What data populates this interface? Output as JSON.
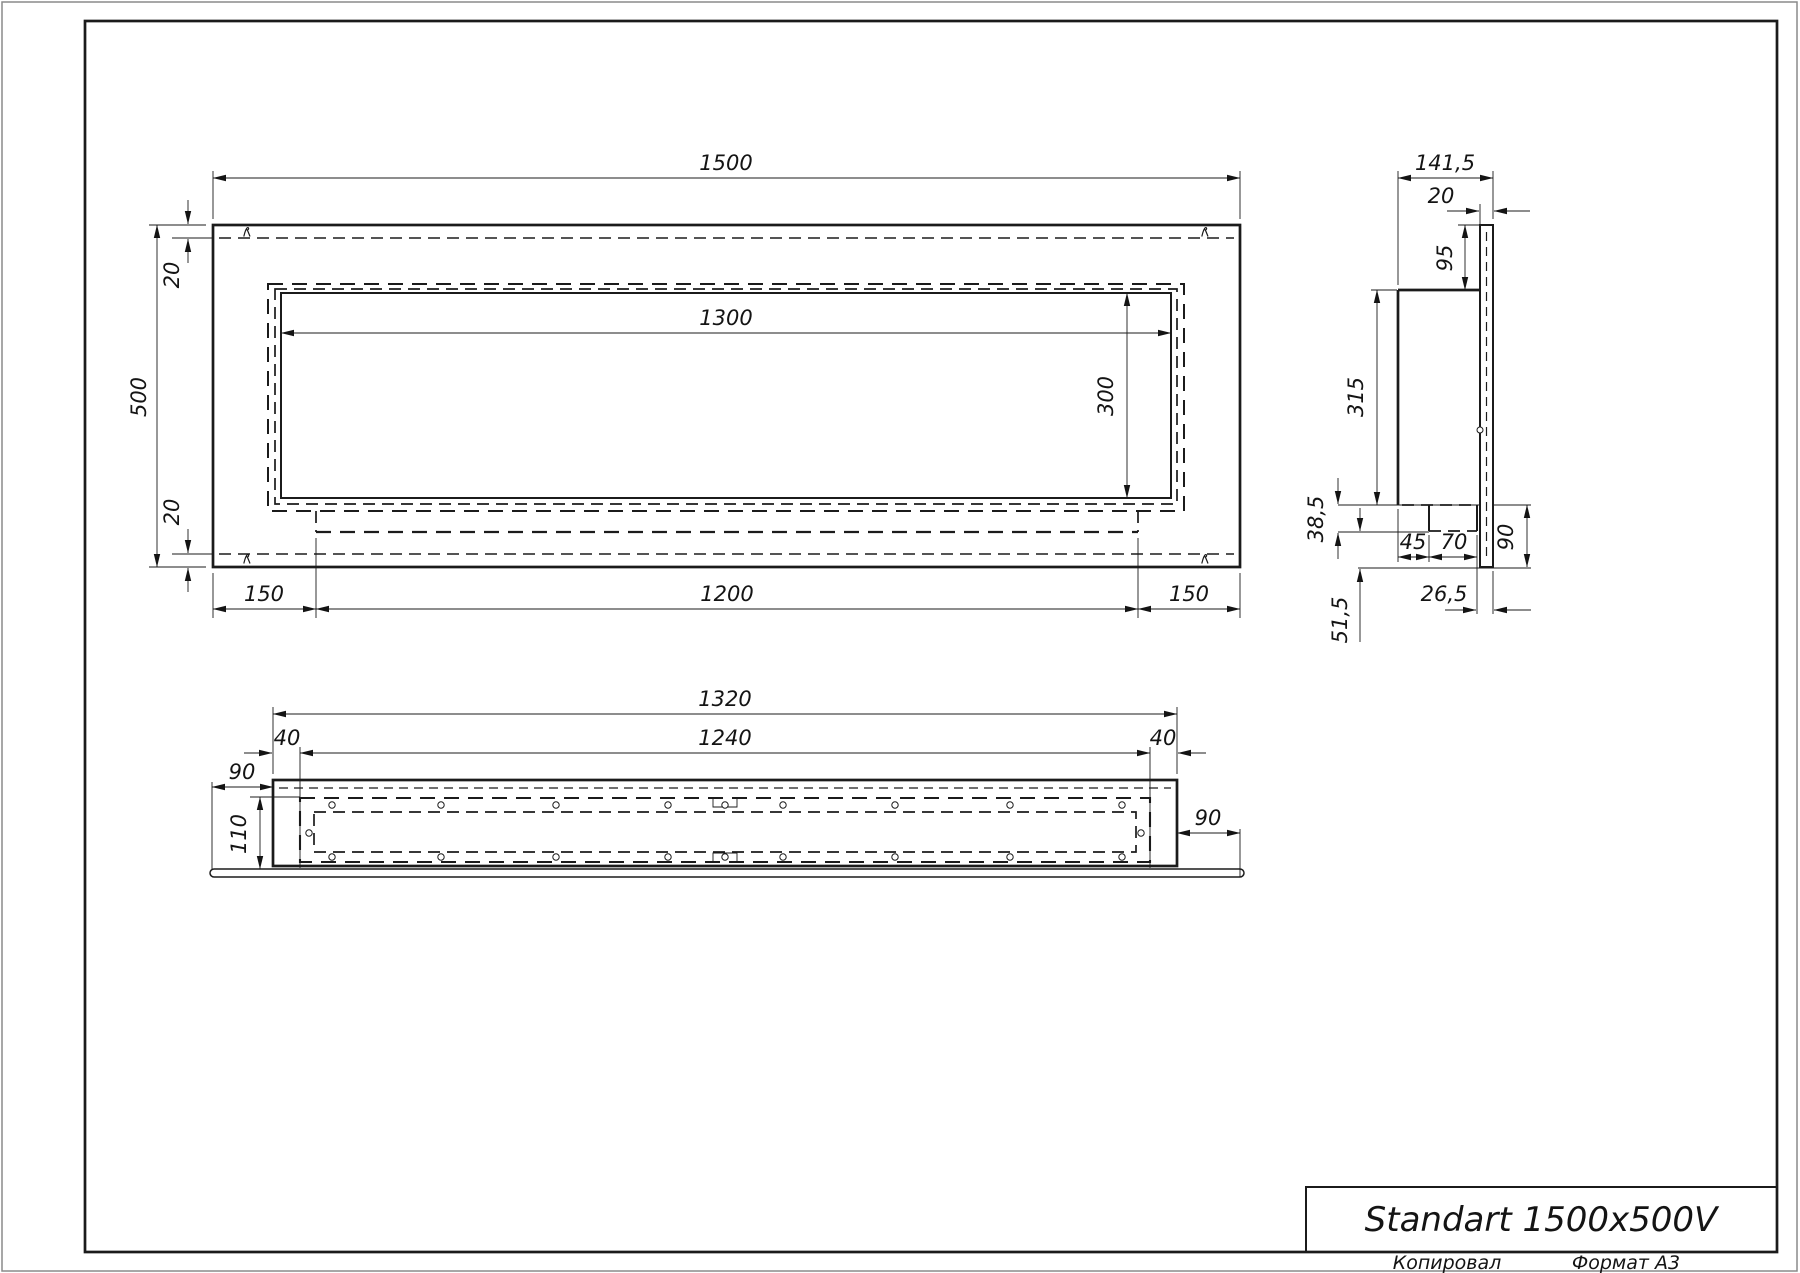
{
  "title_block": {
    "title": "Standart 1500x500V"
  },
  "footer": {
    "copied": "Копировал",
    "format": "Формат А3"
  },
  "dims": {
    "front": {
      "overall_width": "1500",
      "overall_height": "500",
      "top_margin": "20",
      "bottom_margin": "20",
      "opening_width": "1300",
      "opening_height": "300",
      "left_offset": "150",
      "burner_length": "1200",
      "right_offset": "150"
    },
    "side": {
      "overall_depth": "141,5",
      "panel_thickness": "20",
      "top_offset": "95",
      "body_height": "315",
      "tray_height": "38,5",
      "tray_setback": "45",
      "tray_depth": "70",
      "bottom_height": "90",
      "back_gap": "26,5",
      "bottom_setback": "51,5"
    },
    "plan": {
      "body_width": "1320",
      "insert_width": "1240",
      "left_gap": "40",
      "right_gap": "40",
      "left_flange": "90",
      "inner_depth": "110",
      "right_flange": "90"
    }
  }
}
